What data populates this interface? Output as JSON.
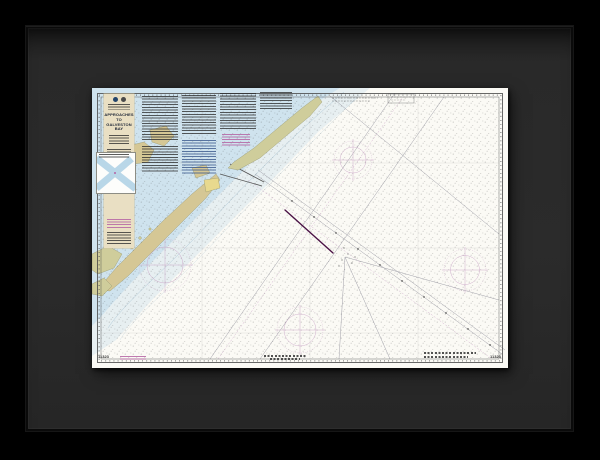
{
  "artwork": {
    "kind": "framed-nautical-chart-print",
    "chart": {
      "title": {
        "line1": "APPROACHES TO",
        "line2": "GALVESTON BAY"
      },
      "corner_numbers": {
        "bottom_left": "11323",
        "bottom_right": "11323"
      },
      "logos": [
        {
          "name": "noaa-logo"
        },
        {
          "name": "commerce-logo"
        }
      ]
    },
    "colors": {
      "background": "#000000",
      "frame": "#0a0a0a",
      "mat": "#282828",
      "paper": "#fbfaf5",
      "shallow_water": "#cfe3ee",
      "land": "#d5c795",
      "marsh_land": "#cfcd9b",
      "city": "#e8d98e",
      "title_block": "#e9dfc3",
      "magenta": "#b564a4",
      "compass_rose": "#c9a2c6",
      "course_line": "#4a1245",
      "ink": "#2b2b2b"
    }
  }
}
